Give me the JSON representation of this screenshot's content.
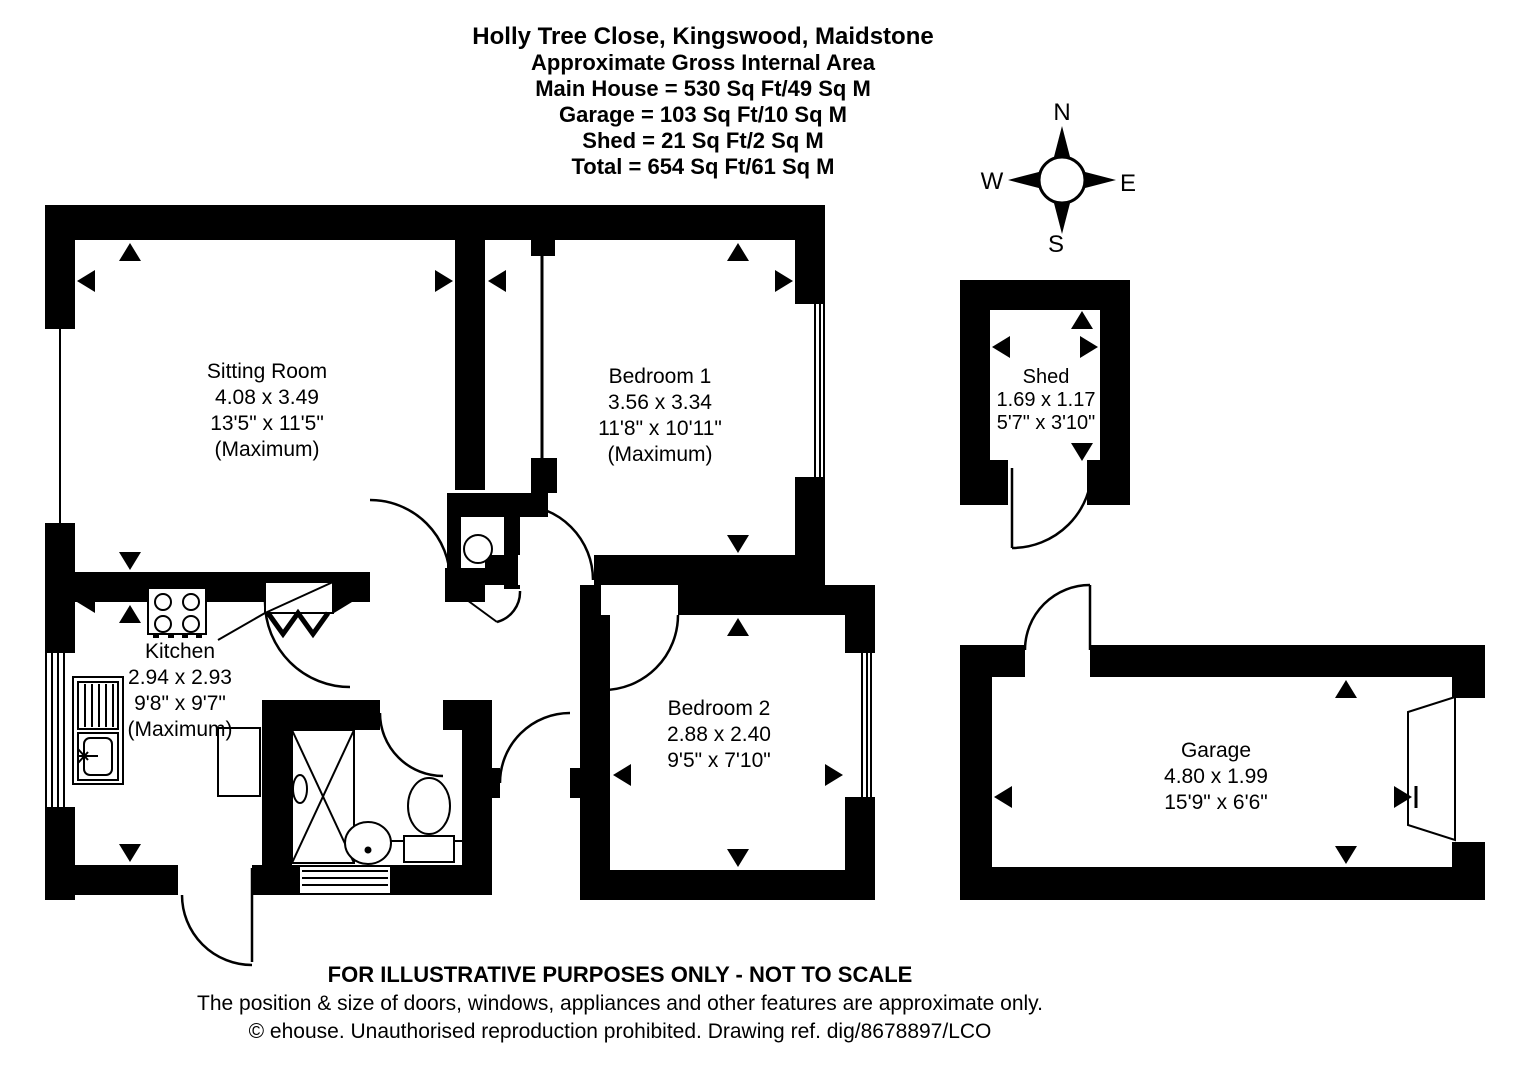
{
  "title": {
    "line1": "Holly Tree Close, Kingswood, Maidstone",
    "line2": "Approximate Gross Internal Area",
    "line3": "Main House = 530 Sq Ft/49 Sq M",
    "line4": "Garage = 103 Sq Ft/10 Sq M",
    "line5": "Shed = 21 Sq Ft/2 Sq M",
    "line6": "Total = 654 Sq Ft/61 Sq M"
  },
  "compass": {
    "n": "N",
    "e": "E",
    "s": "S",
    "w": "W"
  },
  "rooms": {
    "sitting_room": {
      "name": "Sitting Room",
      "metric": "4.08 x 3.49",
      "imperial": "13'5\" x 11'5\"",
      "note": "(Maximum)"
    },
    "bedroom1": {
      "name": "Bedroom 1",
      "metric": "3.56 x 3.34",
      "imperial": "11'8\" x 10'11\"",
      "note": "(Maximum)"
    },
    "kitchen": {
      "name": "Kitchen",
      "metric": "2.94 x 2.93",
      "imperial": "9'8\" x 9'7\"",
      "note": "(Maximum)"
    },
    "bedroom2": {
      "name": "Bedroom 2",
      "metric": "2.88 x 2.40",
      "imperial": "9'5\" x 7'10\""
    },
    "shed": {
      "name": "Shed",
      "metric": "1.69 x 1.17",
      "imperial": "5'7\" x 3'10\""
    },
    "garage": {
      "name": "Garage",
      "metric": "4.80 x 1.99",
      "imperial": "15'9\" x 6'6\""
    }
  },
  "footer": {
    "line1": "FOR ILLUSTRATIVE PURPOSES ONLY - NOT TO SCALE",
    "line2": "The position & size of doors, windows, appliances and other features are approximate only.",
    "line3": "© ehouse. Unauthorised reproduction prohibited. Drawing ref. dig/8678897/LCO"
  },
  "colors": {
    "wall": "#000000",
    "background": "#ffffff"
  }
}
